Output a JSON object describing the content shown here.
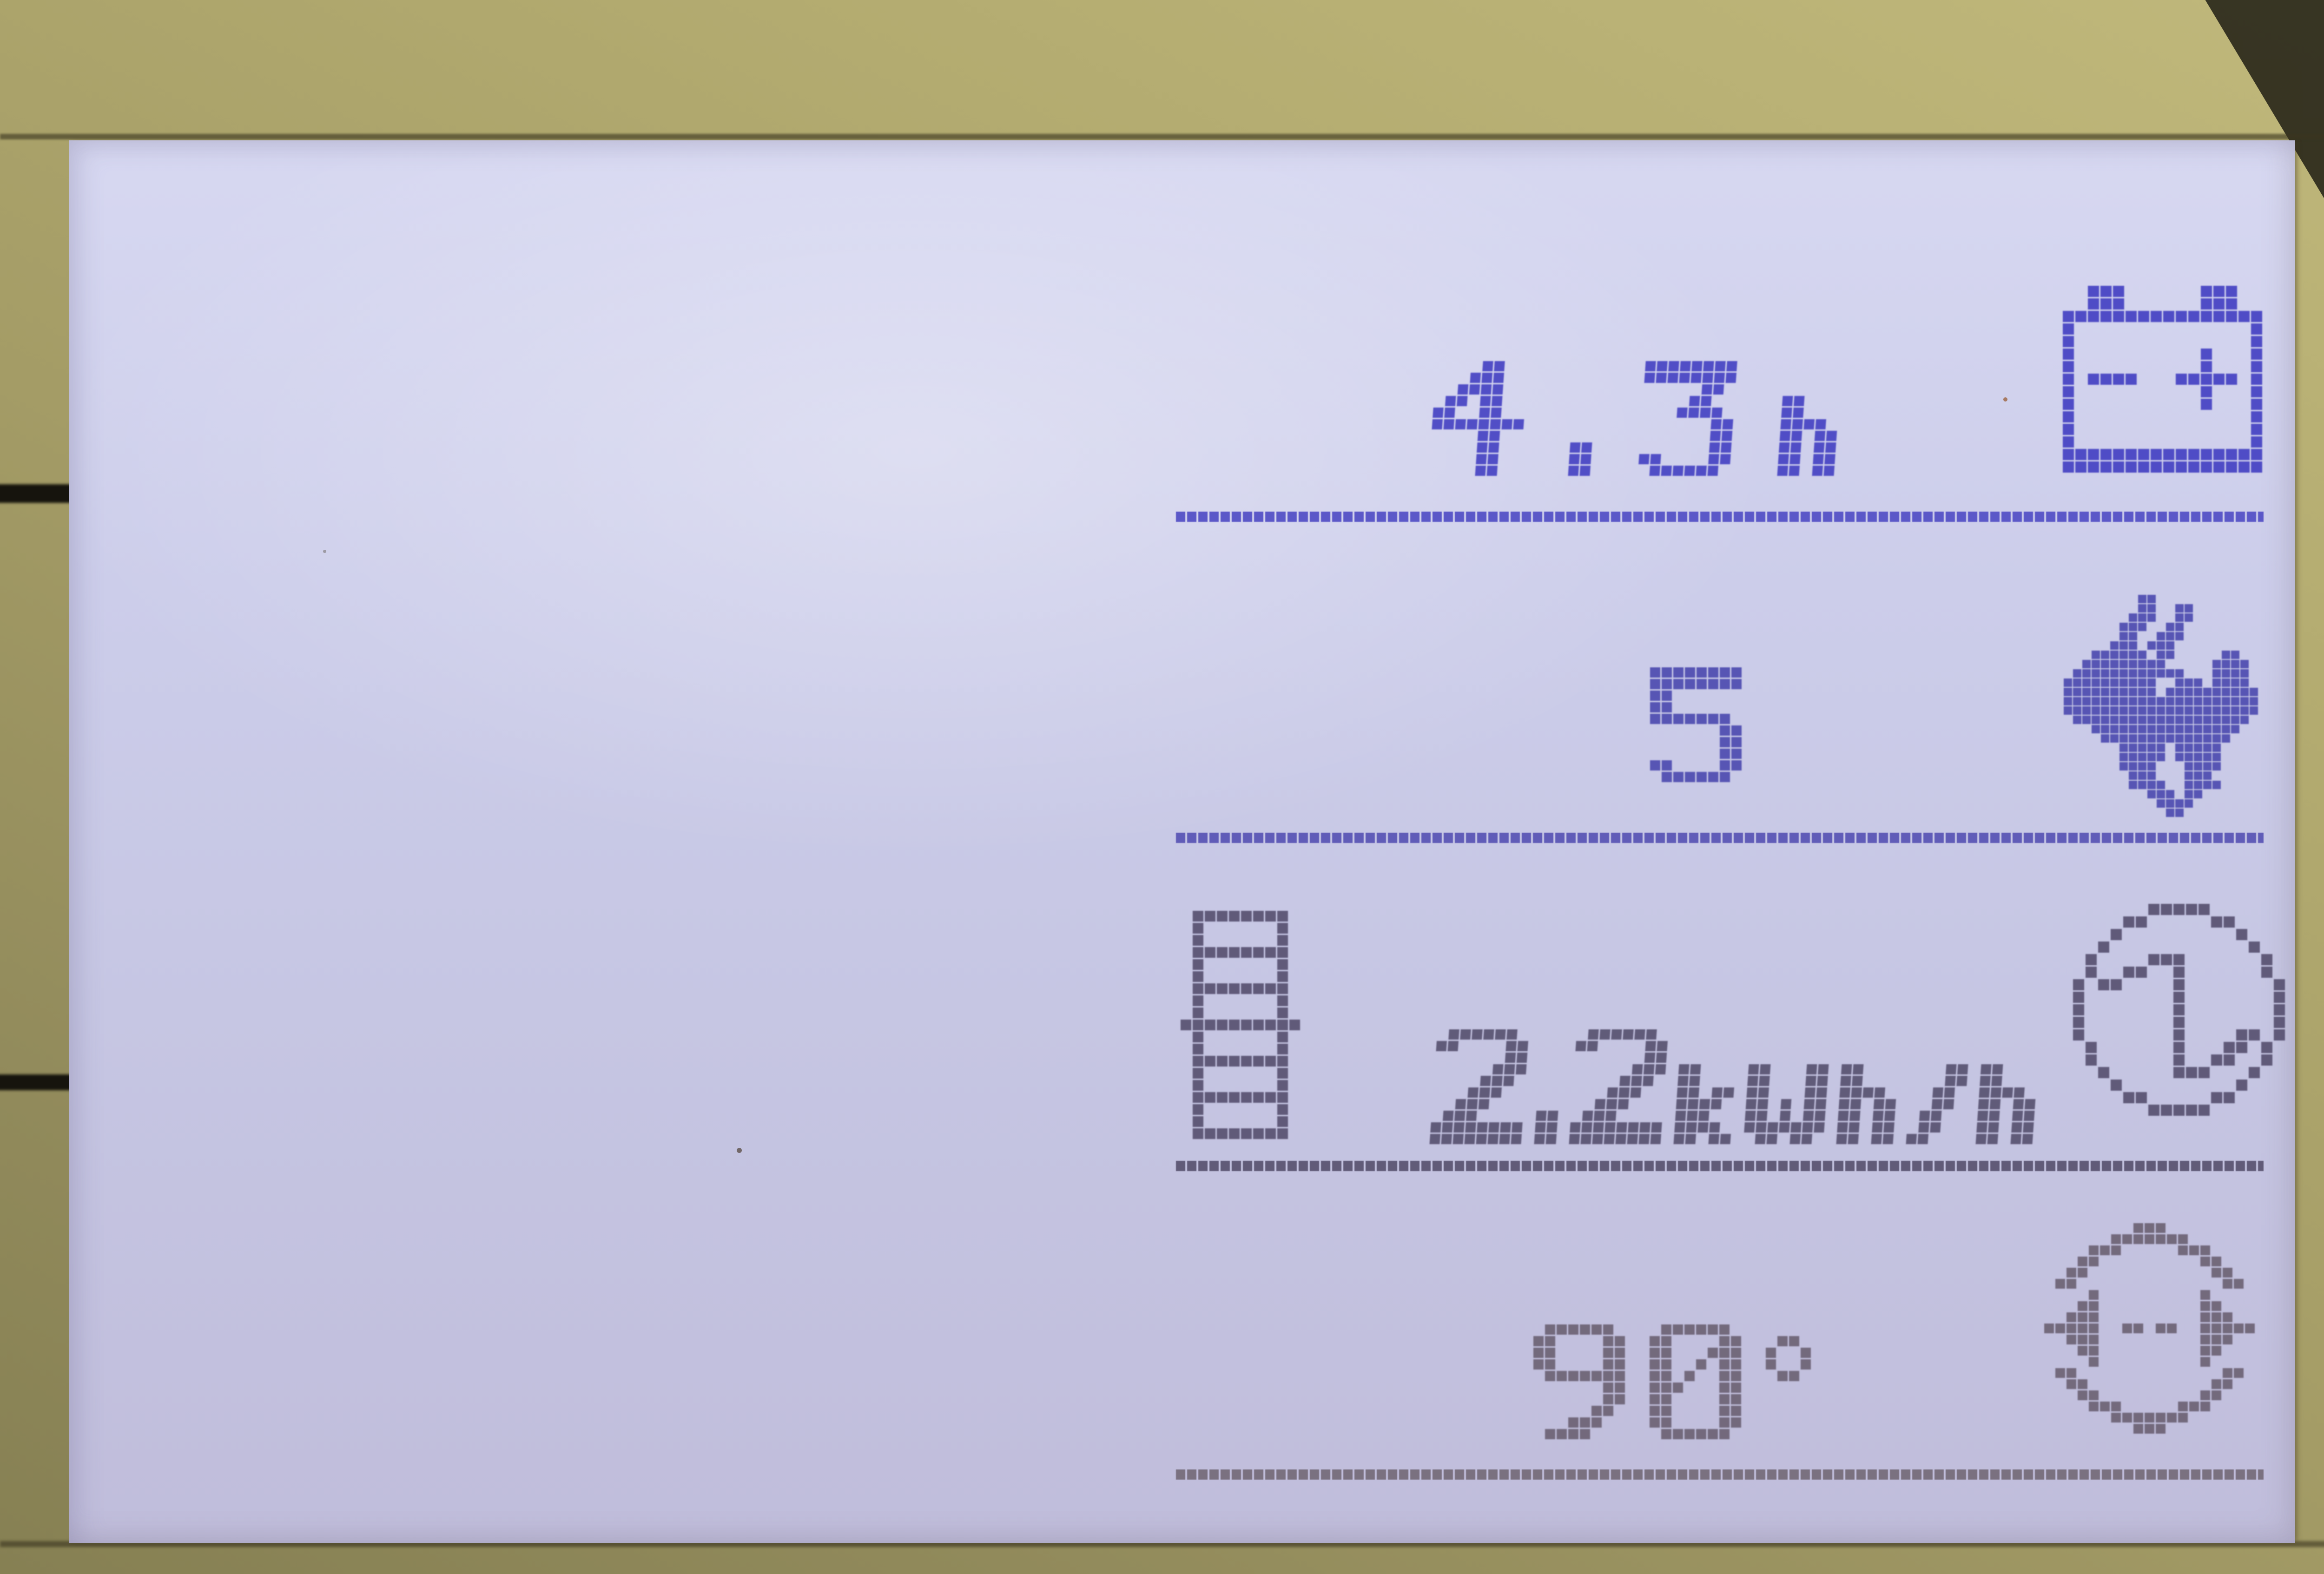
{
  "device": {
    "kind": "machine-control-lcd",
    "screen": "dot-matrix-display"
  },
  "colors": {
    "bezel_light": "#c0b87b",
    "bezel_mid": "#a49c66",
    "bezel_dark": "#868053",
    "lcd_top": "#d7d8f1",
    "lcd_mid": "#c6c6e3",
    "lcd_bottom": "#c0bddb",
    "row1": "#4a47c4",
    "row2": "#5250b2",
    "row3": "#5b5574",
    "row4": "#6f6678",
    "underline1": "#5b58c8",
    "underline2": "#605cb8",
    "underline3": "#615b78",
    "underline4": "#7a7180"
  },
  "rows": [
    {
      "name": "battery-runtime",
      "display": "4.3h",
      "value": "4.3",
      "unit": "h",
      "icon": "battery"
    },
    {
      "name": "speed-level",
      "display": "5",
      "value": "5",
      "unit": "",
      "icon": "rabbit"
    },
    {
      "name": "energy-rate",
      "display": "2.2kWh/h",
      "value": "2.2",
      "unit": "kWh/h",
      "icon": "energy-meter",
      "icon_left": "level-gauge"
    },
    {
      "name": "spread-angle",
      "display": "90°",
      "value": "90",
      "unit": "°",
      "icon": "spread-width"
    }
  ]
}
